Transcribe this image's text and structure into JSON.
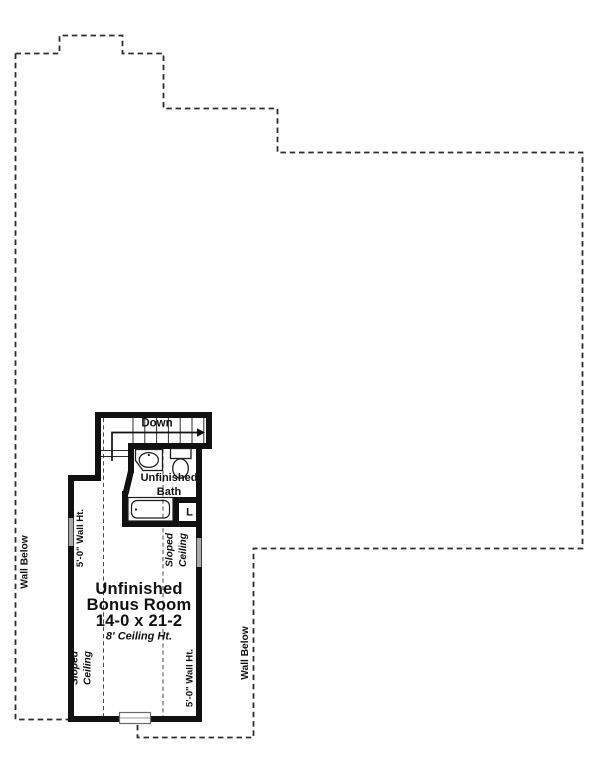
{
  "floor_plan": {
    "stairs": {
      "direction_label": "Down"
    },
    "bath": {
      "label_line1": "Unfinished",
      "label_line2": "Bath",
      "closet_label": "L"
    },
    "bonus_room": {
      "label_line1": "Unfinished",
      "label_line2": "Bonus Room",
      "dimensions": "14-0 x 21-2",
      "ceiling_note": "8' Ceiling Ht."
    },
    "annotations": {
      "wall_below_left": "Wall Below",
      "wall_below_right": "Wall Below",
      "wall_height_left": "5'-0\" Wall Ht.",
      "wall_height_right": "5'-0\" Wall Ht.",
      "sloped_ceiling_upper_line1": "Sloped",
      "sloped_ceiling_upper_line2": "Ceiling",
      "sloped_ceiling_lower_line1": "Sloped",
      "sloped_ceiling_lower_line2": "Ceiling"
    },
    "colors": {
      "wall": "#111111",
      "dash_outline": "#2d2d2d",
      "window_glass": "#a8a8a8",
      "background": "#ffffff",
      "text": "#111111"
    }
  }
}
